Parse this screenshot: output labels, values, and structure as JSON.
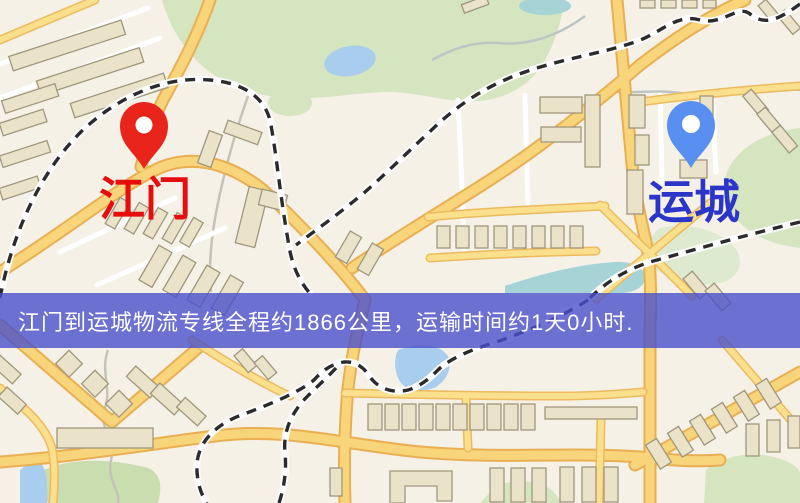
{
  "map": {
    "markers": {
      "origin": {
        "name": "江门",
        "pin_color": "#e8241b",
        "label_color": "#e60d0d"
      },
      "destination": {
        "name": "运城",
        "pin_color": "#5a8ff2",
        "label_color": "#2b36c9"
      }
    },
    "palette": {
      "background": "#f5f1e7",
      "road_fill": "#f8d57b",
      "road_casing": "#e9af52",
      "minor_road": "#ffffff",
      "park_green": "#d5e5c0",
      "water_blue": "#a9cdec",
      "water_teal": "#a6d4d6",
      "railway_dash": "#2b2b2b",
      "building_fill": "#eae2c9",
      "building_stroke": "#a0977c"
    }
  },
  "banner": {
    "text": "江门到运城物流专线全程约1866公里，运输时间约1天0小时.",
    "background": "rgba(74,80,202,0.8)",
    "text_color": "#ffffff"
  }
}
